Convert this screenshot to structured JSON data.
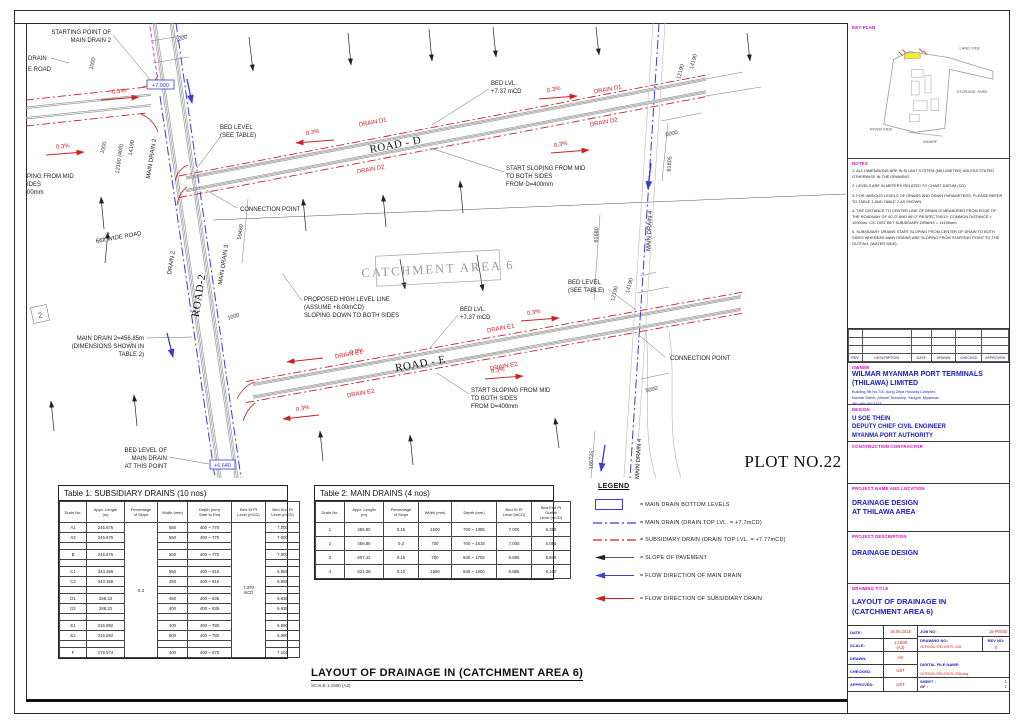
{
  "colors": {
    "main_drain": "#3b3bd6",
    "subsidiary_drain": "#cc2222",
    "label_magenta": "#dd00cc",
    "value_blue": "#1a1abb",
    "value_red": "#cc2222"
  },
  "plan": {
    "slope": "0.3%",
    "plot_no": "PLOT NO.22",
    "catchment": "CATCHMENT AREA 6",
    "grid2": "2",
    "roads": {
      "road_d": "ROAD - D",
      "road_e": "ROAD - E",
      "road_2": "ROAD-2"
    },
    "drains": {
      "d1": "DRAIN D1",
      "d2": "DRAIN D2",
      "e1": "DRAIN E1",
      "e2": "DRAIN E2",
      "main2": "MAIN DRAIN 2",
      "main3": "MAIN DRAIN 3",
      "main4": "MAIN DRAIN 4",
      "drain2": "DRAIN 2"
    },
    "levels": {
      "l7000": "+7.000",
      "l6640": "+6.640"
    },
    "dims": {
      "d1000": "1000",
      "d12190_40": "12190 (40ft)",
      "d12190": "12190",
      "d14190": "14190",
      "d5000": "5000",
      "d59460": "59460",
      "d61605": "61605",
      "d61680": "61680",
      "d166725": "166725"
    },
    "labels": {
      "starting_point": [
        "STARTING POINT OF",
        "MAIN DRAIN 2"
      ],
      "drain_cut": "DRAIN",
      "road_cut": "E ROAD",
      "sloping_cut": [
        "PING FROM MID",
        "IDES",
        "00mm"
      ],
      "bed_level_table": [
        "BED LEVEL",
        "(SEE TABLE)"
      ],
      "connection_point": "CONNECTION POINT",
      "bed_lvl": [
        "BED LVL.",
        "+7.37  mCD"
      ],
      "start_sloping": [
        "START SLOPING FROM MID",
        "TO BOTH SIDES",
        "FROM D=400mm"
      ],
      "proposed": [
        "PROPOSED HIGH LEVEL LINE",
        "(ASSUME  +8.00mCD)",
        "SLOPING DOWN TO BOTH SIDES"
      ],
      "main_drain2_dim": [
        "MAIN DRAIN 2=456.85m",
        "(DIMENSIONS SHOWN IN",
        "TABLE 2)"
      ],
      "bed_level_main": [
        "BED LEVEL OF",
        "MAIN DRAIN",
        "AT THIS POINT"
      ],
      "wide_road_66": "66ft  WIDE ROAD"
    }
  },
  "tables": {
    "table1": {
      "title": "Table 1: SUBSIDIARY DRAINS (10 nos)",
      "headers": [
        "Drain No.",
        "Appx. Length\n(m)",
        "Percentage\nof Slope",
        "Width (mm)",
        "Depth (mm)\nStart to End",
        "Bed St Pt\nLevel (mCD)",
        "Bed End Pt\nLevel (mCD)"
      ],
      "slope_merged": "0.3",
      "bed_st_merged": "7.370\nmCD",
      "rows": [
        {
          "no": "A1",
          "len": "245.675",
          "width": "550",
          "depth": "400 ~ 770",
          "end": "7.000"
        },
        {
          "no": "A2",
          "len": "245.675",
          "width": "550",
          "depth": "400 ~ 770",
          "end": "7.000"
        },
        {
          "no": "",
          "len": "",
          "width": "",
          "depth": "",
          "end": ""
        },
        {
          "no": "B",
          "len": "245.675",
          "width": "550",
          "depth": "400 ~ 770",
          "end": "7.000"
        },
        {
          "no": "",
          "len": "",
          "width": "",
          "depth": "",
          "end": ""
        },
        {
          "no": "C1",
          "len": "343.366",
          "width": "550",
          "depth": "400 ~ 915",
          "end": "6.855"
        },
        {
          "no": "C2",
          "len": "343.366",
          "width": "450",
          "depth": "400 ~ 915",
          "end": "6.855"
        },
        {
          "no": "",
          "len": "",
          "width": "",
          "depth": "",
          "end": ""
        },
        {
          "no": "D1",
          "len": "288.33",
          "width": "450",
          "depth": "400 ~ 835",
          "end": "6.935"
        },
        {
          "no": "D2",
          "len": "288.33",
          "width": "400",
          "depth": "400 ~ 835",
          "end": "6.935"
        },
        {
          "no": "",
          "len": "",
          "width": "",
          "depth": "",
          "end": ""
        },
        {
          "no": "E1",
          "len": "215.892",
          "width": "400",
          "depth": "400 ~ 780",
          "end": "6.990"
        },
        {
          "no": "E2",
          "len": "215.892",
          "width": "500",
          "depth": "400 ~ 780",
          "end": "6.990"
        },
        {
          "no": "",
          "len": "",
          "width": "",
          "depth": "",
          "end": ""
        },
        {
          "no": "F",
          "len": "178.574",
          "width": "400",
          "depth": "400 ~ 670",
          "end": "7.102"
        }
      ]
    },
    "table2": {
      "title": "Table 2: MAIN DRAINS (4 nos)",
      "headers": [
        "Drain No.",
        "Appx. Length\n(m)",
        "Percentage\nof Slope",
        "Width (mm)",
        "Depth (mm)",
        "Bed St Pt\nLevel (mCD)",
        "Bed End Pt\nOutfall\nLevel (mCD)"
      ],
      "rows": [
        [
          "1",
          "456.80",
          "0.15",
          "1500",
          "700 ~ 1385",
          "7.000",
          "6.315"
        ],
        [
          "2",
          "456.85",
          "0.2",
          "700",
          "700 ~ 1615",
          "7.000",
          "6.085"
        ],
        [
          "3",
          "607.42",
          "0.15",
          "700",
          "845 ~ 1755",
          "6.855",
          "5.945"
        ],
        [
          "4",
          "631.38",
          "0.12",
          "1500",
          "845 ~ 1600",
          "6.855",
          "6.100"
        ]
      ]
    }
  },
  "legend": {
    "title": "LEGEND",
    "items": [
      {
        "symbol": "blue-box",
        "text": "=  MAIN DRAIN BOTTOM LEVELS"
      },
      {
        "symbol": "blue-dashdot",
        "text": "=  MAIN DRAIN (DRAIN TOP LVL. = +7.7mCD)"
      },
      {
        "symbol": "red-dashdot",
        "text": "=  SUBSIDIARY DRAIN (DRAIN TOP LVL. = +7.77mCD)"
      },
      {
        "symbol": "black-arrow",
        "text": "=  SLOPE OF PAVEMENT"
      },
      {
        "symbol": "blue-arrow",
        "text": "=  FLOW DIRECTION OF MAIN DRAIN"
      },
      {
        "symbol": "red-arrow",
        "text": "=  FLOW DIRECTION OF SUBSIDIARY DRAIN"
      }
    ]
  },
  "caption": {
    "title": "LAYOUT OF DRAINAGE IN (CATCHMENT AREA 6)",
    "scale": "SCALE 1:1500 (A3)"
  },
  "panel": {
    "key_plan": {
      "label": "KEY PLAN",
      "land_side": "LAND SIDE",
      "storage_yard": "STORAGE YARD",
      "river_side": "RIVER SIDE",
      "wharf": "WHARF"
    },
    "notes": {
      "label": "NOTES",
      "items": [
        "1. ALL DIMENSIONS ARE IN SI UNIT SYSTEM (MILLIMETER) UNLESS STATED OTHERWISE IN THE DRAWING.",
        "2. LEVELS ARE IN METERS RELATED TO CHART DATUM (CD).",
        "3. FOR VARIOUS LEVELS OF DRAINS AND DRAIN PARAMETERS, PLEASE REFER TO TABLE 1 AND TABLE 2 AS SHOWN.",
        "4. THE DISTANCE TO CENTER LINE OF DRAIN IS MEASURED FROM EDGE OF THE ROADWAY OF 40'-0\" AND 66'-0\" RESPECTIVELY. COMMON DISTANCE = 1000mm. C/C DIST BET SUBSIDIARY DRAINS = 14190mm",
        "5. SUBSIDIARY DRAINS START SLOPING FROM CENTER OF DRAIN TO BOTH SIDES WHEREAS MAIN DRAINS ARE SLOPING FROM STARTING POINT TO THE OUTFALL (WATER SIDE)."
      ]
    },
    "revision": {
      "headers": [
        "REV.",
        "DESCRIPTION",
        "DATE",
        "DRAWN",
        "CHECKED",
        "APPROVED"
      ]
    },
    "owner": {
      "label": "OWNER",
      "name": [
        "WILMAR MYANMAR PORT TERMINALS",
        "(THILAWA) LIMITED"
      ],
      "address": [
        "Building 9B No.7/A, Aung Zeya Housing Complex,",
        "Kannar Street, Ahlone Township, Yangon, Myanmar.",
        "Tel: +95-9512233"
      ]
    },
    "design": {
      "label": "DESIGN",
      "lines": [
        "U SOE THEIN",
        "DEPUTY CHIEF CIVIL ENGINEER",
        "MYANMA PORT AUTHORITY"
      ]
    },
    "contractor": {
      "label": "CONSTRUCTION CONTRACTOR"
    },
    "project_name": {
      "label": "PROJECT NAME AND LOCATION",
      "lines": [
        "DRAINAGE DESIGN",
        "AT THILAWA AREA"
      ]
    },
    "project_description": {
      "label": "PROJECT DESCRIPTION",
      "lines": [
        "DRAINAGE DESIGN"
      ]
    },
    "drawing_title": {
      "label": "DRAWING TITLE",
      "lines": [
        "LAYOUT OF DRAINAGE IN",
        "(CATCHMENT AREA 6)"
      ]
    },
    "info": {
      "date_label": "DATE:",
      "date": "16.06.2015",
      "scale_label": "SCALE:",
      "scale": "1:1500\n(A3)",
      "drawn_label": "DRAWN:",
      "drawn": "AG",
      "checked_label": "CHECKED:",
      "checked": "UST",
      "approved_label": "APPROVED:",
      "approved": "UST",
      "job_label": "JOB NO:",
      "job_no": "15-P0030",
      "drawing_no_label": "DRAWING NO:",
      "drawing_no": "15-P0030-YRD-DR-PL-038",
      "rev_label": "REV NO:",
      "rev_no": "0",
      "file_label": "DIGITAL FILE NAME:",
      "file_name": "15-P0030-YRD-DR-PL-038.dwg",
      "sheet_label": "SHEET :",
      "sheet_no": "1",
      "of_label": "OF :",
      "of_no": "1"
    }
  }
}
